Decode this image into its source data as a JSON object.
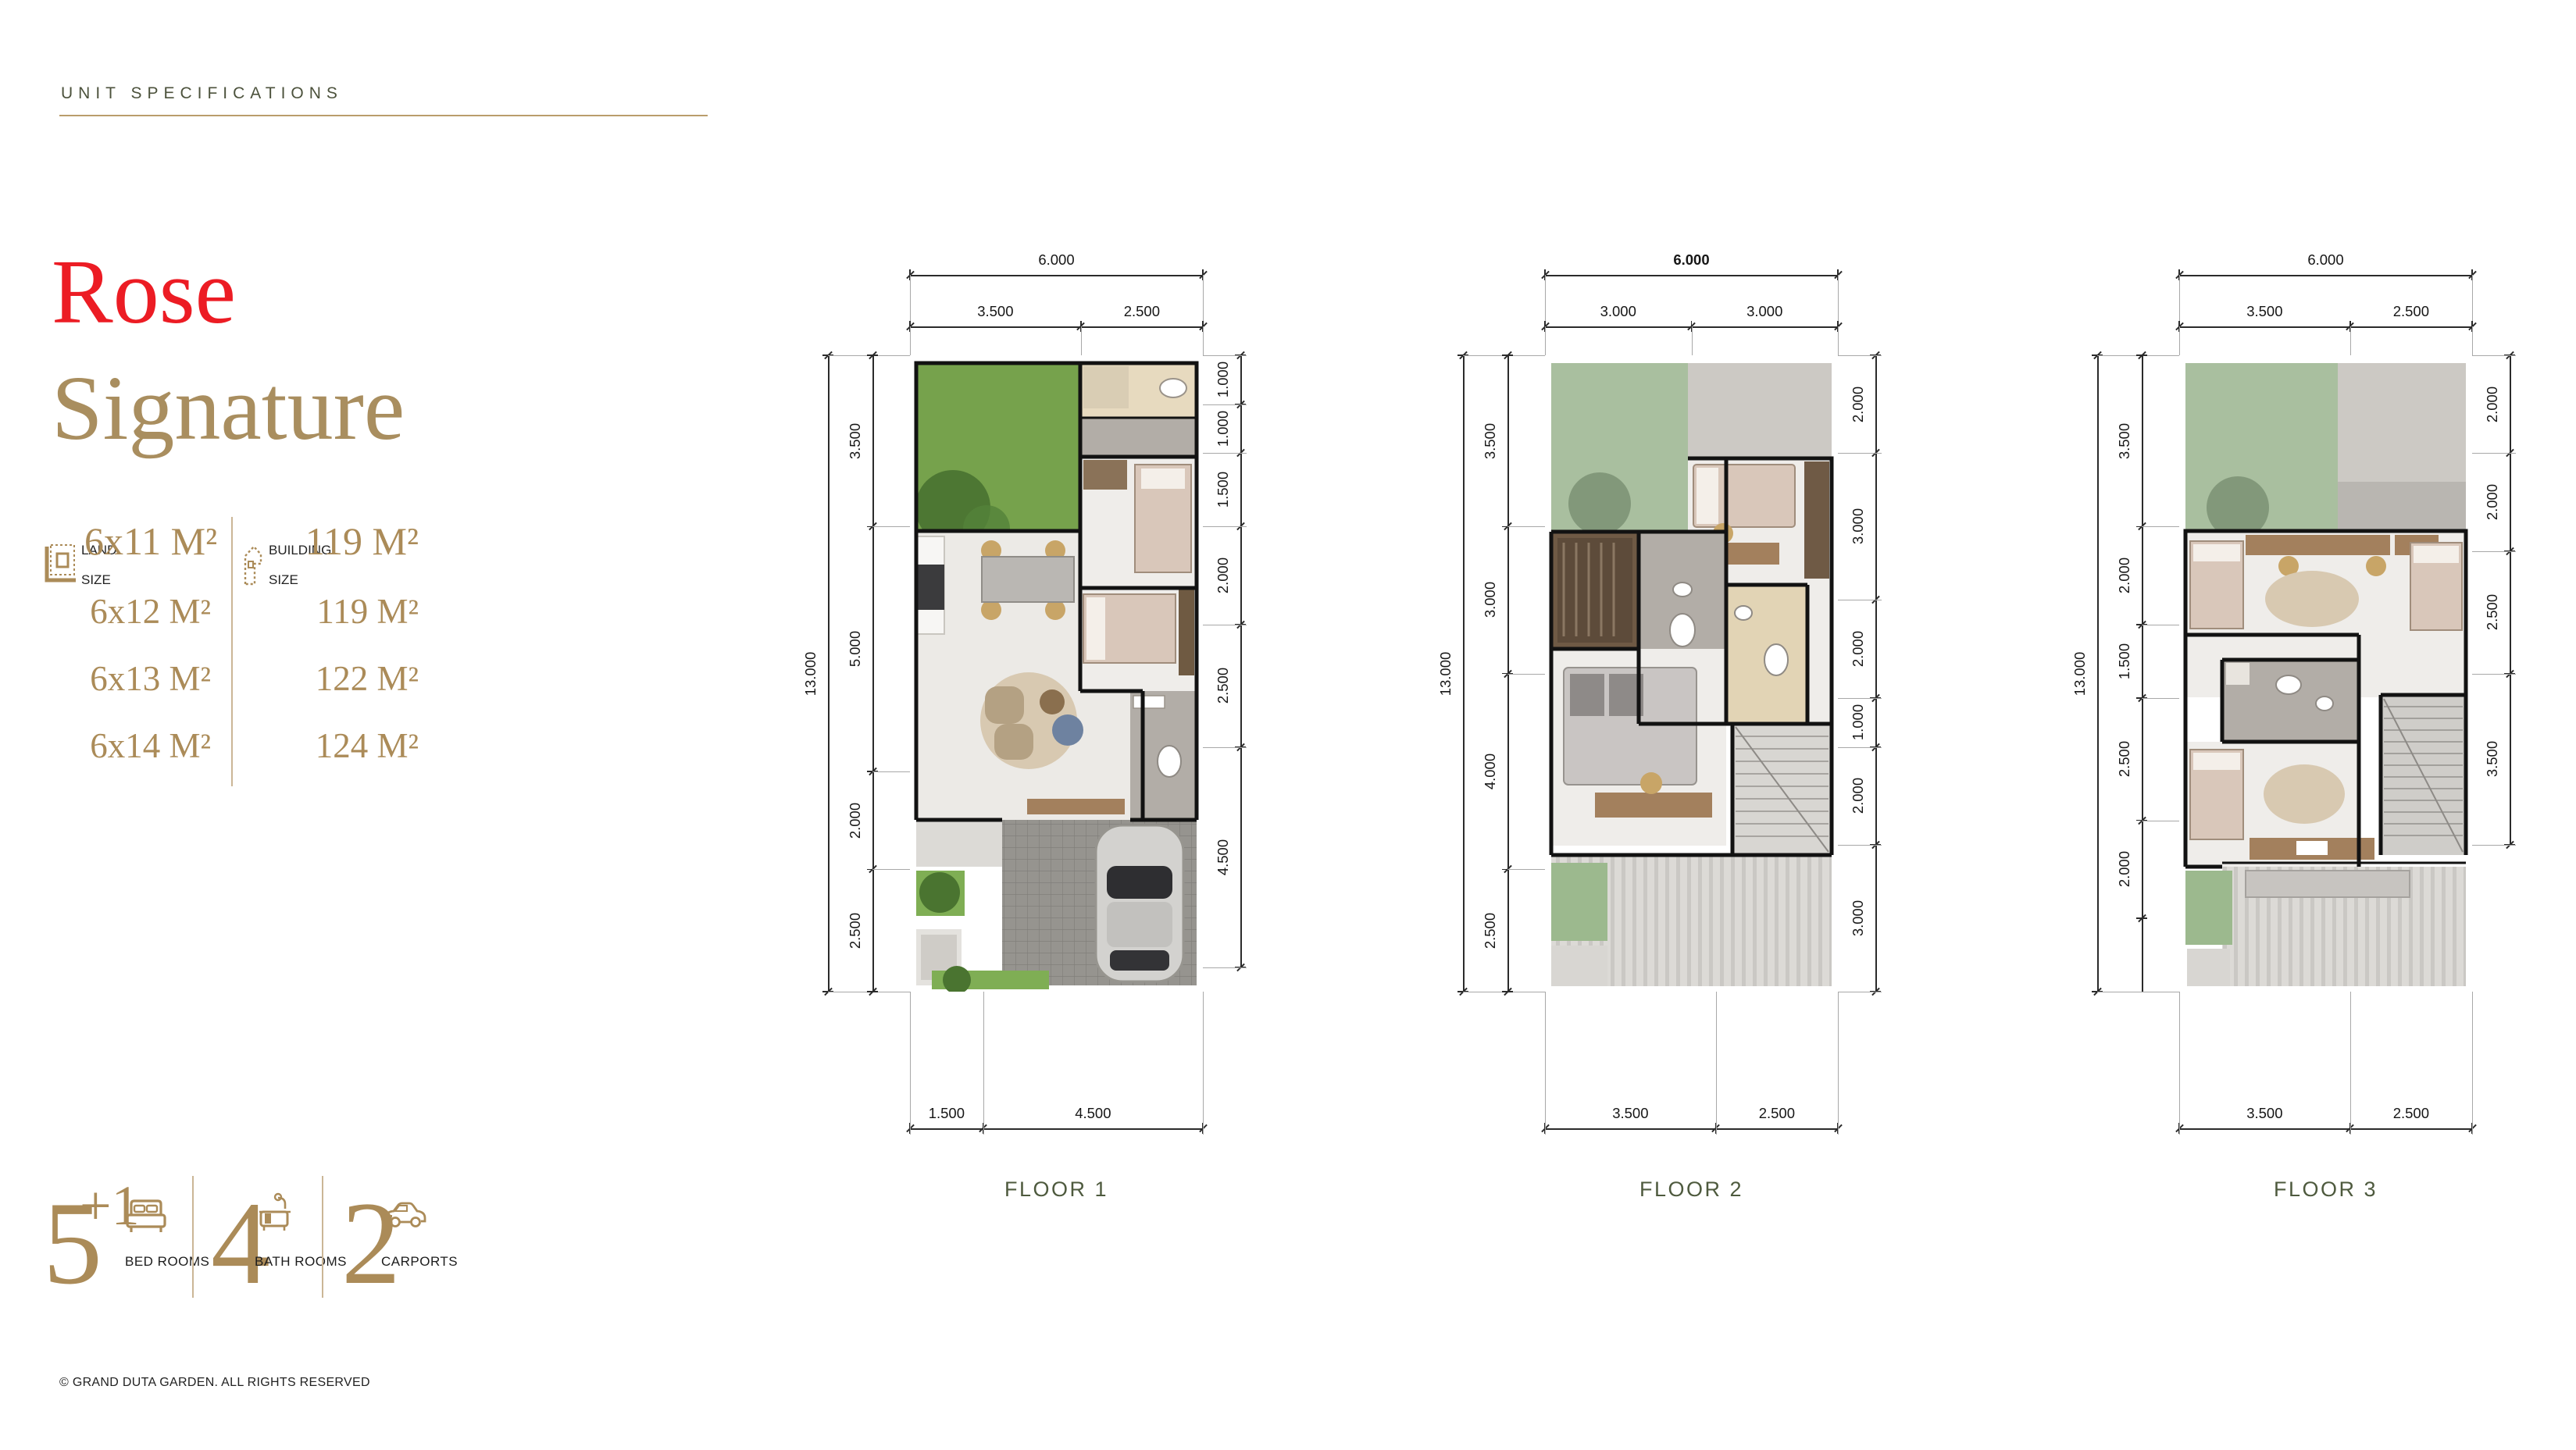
{
  "page": {
    "eyebrow": "UNIT SPECIFICATIONS",
    "title_line1": "Rose",
    "title_line2": "Signature",
    "copyright": "© GRAND DUTA GARDEN. ALL RIGHTS RESERVED"
  },
  "specs": {
    "land": {
      "icon": "land-size-icon",
      "label_line1": "LAND",
      "label_line2": "SIZE",
      "values": [
        "6x11 M²",
        "6x12 M²",
        "6x13 M²",
        "6x14 M²"
      ]
    },
    "building": {
      "icon": "building-size-icon",
      "label_line1": "BUILDING",
      "label_line2": "SIZE",
      "values": [
        "119 M²",
        "119 M²",
        "122 M²",
        "124 M²"
      ]
    }
  },
  "amenities": [
    {
      "count": "5",
      "sup": "+1",
      "label": "BED ROOMS",
      "icon": "bed-icon"
    },
    {
      "count": "4",
      "sup": "",
      "label": "BATH ROOMS",
      "icon": "bath-icon"
    },
    {
      "count": "2",
      "sup": "",
      "label": "CARPORTS",
      "icon": "car-icon"
    }
  ],
  "floors": [
    {
      "name": "FLOOR 1",
      "top_total": "6.000",
      "top_total_bold": false,
      "top_segments": [
        "3.500",
        "2.500"
      ],
      "left_total": "13.000",
      "left_segments": [
        "3.500",
        "5.000",
        "2.000",
        "2.500"
      ],
      "right_segments": [
        "1.000",
        "1.000",
        "1.500",
        "2.000",
        "2.500",
        "4.500"
      ],
      "bottom_segments": [
        "1.500",
        "4.500"
      ]
    },
    {
      "name": "FLOOR 2",
      "top_total": "6.000",
      "top_total_bold": true,
      "top_segments": [
        "3.000",
        "3.000"
      ],
      "left_total": "13.000",
      "left_segments": [
        "3.500",
        "3.000",
        "4.000",
        "2.500"
      ],
      "right_segments": [
        "2.000",
        "3.000",
        "2.000",
        "1.000",
        "2.000",
        "3.000"
      ],
      "bottom_segments": [
        "3.500",
        "2.500"
      ]
    },
    {
      "name": "FLOOR 3",
      "top_total": "6.000",
      "top_total_bold": false,
      "top_segments": [
        "3.500",
        "2.500"
      ],
      "left_total": "13.000",
      "left_segments": [
        "3.500",
        "2.000",
        "1.500",
        "2.500",
        "2.000"
      ],
      "right_segments": [
        "2.000",
        "2.000",
        "2.500",
        "3.500"
      ],
      "bottom_segments": [
        "3.500",
        "2.500"
      ]
    }
  ],
  "colors": {
    "accent_red": "#ec1c24",
    "accent_gold": "#ab8b58",
    "olive": "#4e5a3e",
    "line_gold": "#b99d6b"
  }
}
